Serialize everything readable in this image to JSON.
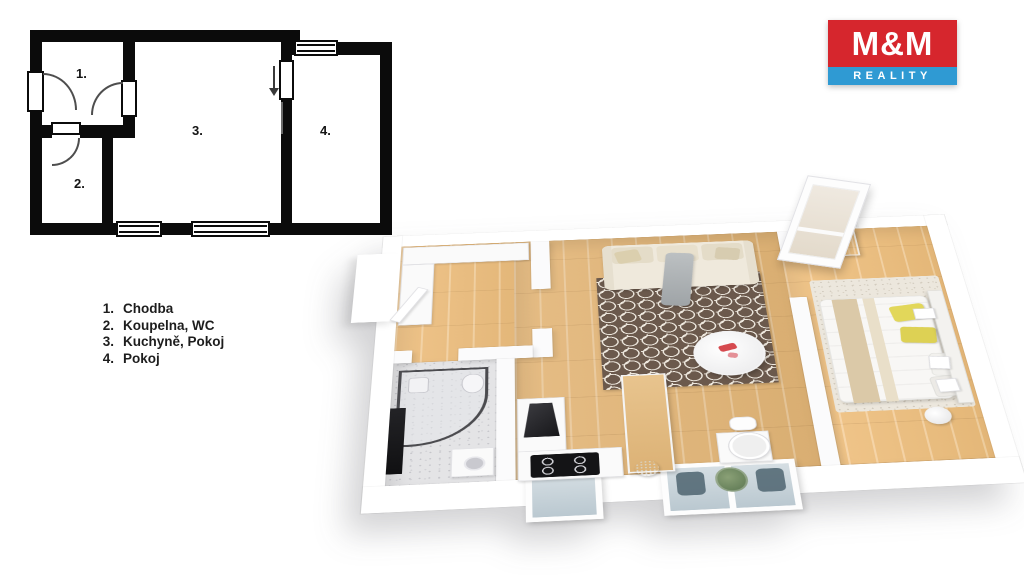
{
  "page": {
    "background": "#ffffff"
  },
  "logo": {
    "top_text": "M&M",
    "bottom_text": "REALITY",
    "colors": {
      "red": "#d6262d",
      "blue": "#2f9ad3",
      "text": "#ffffff"
    }
  },
  "legend": {
    "items": [
      {
        "number": "1.",
        "label": "Chodba"
      },
      {
        "number": "2.",
        "label": "Koupelna, WC"
      },
      {
        "number": "3.",
        "label": "Kuchyně, Pokoj"
      },
      {
        "number": "4.",
        "label": "Pokoj"
      }
    ]
  },
  "floorplan_2d": {
    "wall_color": "#0b0b0b",
    "room_numbers": [
      "1.",
      "2.",
      "3.",
      "4."
    ]
  },
  "floorplan_3d": {
    "palette": {
      "wood_floor": "#e2b980",
      "rug_brown": "#6b594c",
      "rug_pattern_cream": "#efe9df",
      "bathroom_floor": "#e4e4e6",
      "wall_white": "#fbfbfc",
      "window_glass": "#cdd9df",
      "yellow_pillow": "#e2d75a",
      "plant_green": "#7d936c",
      "sofa_cream": "#efe9dc",
      "wardrobe_wood": "#b8834a",
      "appliance_black": "#141416"
    },
    "rooms": [
      "hallway",
      "bathroom",
      "living-kitchen",
      "bedroom"
    ],
    "furniture": [
      "sofa",
      "honeycomb-rug",
      "coffee-table",
      "dining-table",
      "kitchen-counter",
      "cooktop",
      "range-hood",
      "shower",
      "washing-machine",
      "vanity-mirror-table",
      "bed",
      "yellow-pillows",
      "bedroom-rug",
      "wardrobe",
      "plant",
      "window-bays",
      "tilted-window"
    ]
  }
}
